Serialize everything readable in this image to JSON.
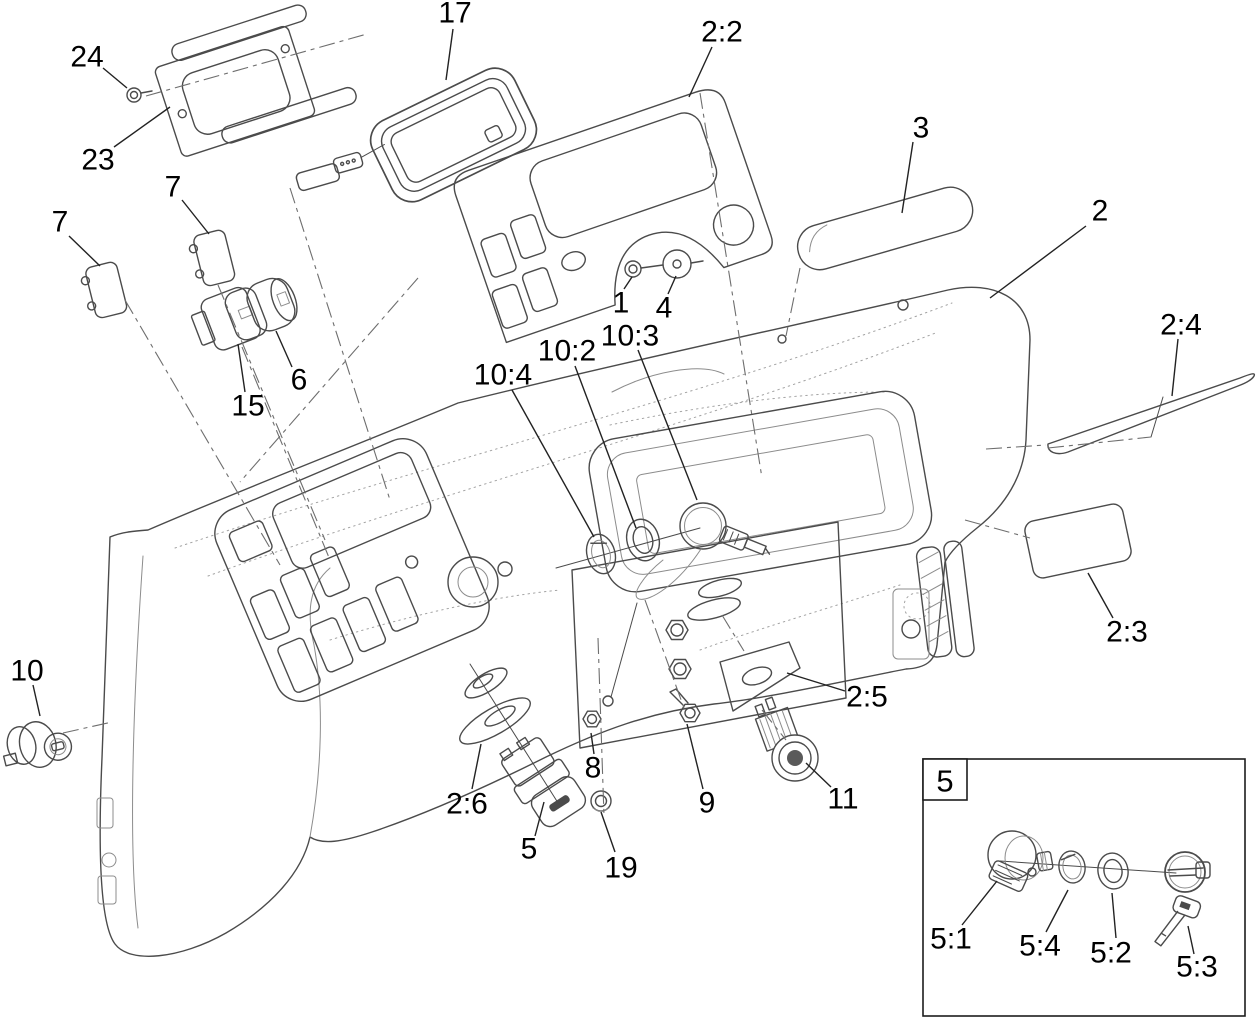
{
  "figure": {
    "type": "exploded-parts-diagram",
    "subject": "console-dashboard-assembly",
    "background_color": "#ffffff",
    "line_color": "#4b4b4b",
    "label_color": "#000000"
  },
  "inset": {
    "label": "5"
  },
  "callouts": [
    {
      "id": "24",
      "label": "24",
      "x": 87,
      "y": 57,
      "leader": [
        103,
        68,
        127,
        88
      ]
    },
    {
      "id": "23",
      "label": "23",
      "x": 98,
      "y": 160,
      "leader": [
        114,
        147,
        170,
        107
      ]
    },
    {
      "id": "17",
      "label": "17",
      "x": 455,
      "y": 13,
      "leader": [
        453,
        29,
        446,
        80
      ]
    },
    {
      "id": "2-2",
      "label": "2:2",
      "x": 722,
      "y": 32,
      "leader": [
        712,
        47,
        689,
        97
      ]
    },
    {
      "id": "3",
      "label": "3",
      "x": 921,
      "y": 128,
      "leader": [
        913,
        142,
        902,
        213
      ]
    },
    {
      "id": "2",
      "label": "2",
      "x": 1100,
      "y": 211,
      "leader": [
        1086,
        226,
        990,
        298
      ]
    },
    {
      "id": "7-upper",
      "label": "7",
      "x": 173,
      "y": 187,
      "leader": [
        182,
        200,
        209,
        234
      ]
    },
    {
      "id": "7-left",
      "label": "7",
      "x": 60,
      "y": 222,
      "leader": [
        69,
        236,
        100,
        266
      ]
    },
    {
      "id": "6",
      "label": "6",
      "x": 299,
      "y": 380,
      "leader": [
        292,
        367,
        276,
        331
      ]
    },
    {
      "id": "15",
      "label": "15",
      "x": 248,
      "y": 406,
      "leader": [
        245,
        392,
        238,
        344
      ]
    },
    {
      "id": "1",
      "label": "1",
      "x": 621,
      "y": 303,
      "leader": [
        624,
        289,
        632,
        277
      ]
    },
    {
      "id": "4",
      "label": "4",
      "x": 664,
      "y": 308,
      "leader": [
        668,
        294,
        676,
        276
      ]
    },
    {
      "id": "10-3",
      "label": "10:3",
      "x": 630,
      "y": 336,
      "leader": [
        638,
        350,
        697,
        500
      ]
    },
    {
      "id": "10-2",
      "label": "10:2",
      "x": 567,
      "y": 351,
      "leader": [
        575,
        366,
        636,
        528
      ]
    },
    {
      "id": "10-4",
      "label": "10:4",
      "x": 503,
      "y": 375,
      "leader": [
        512,
        390,
        594,
        537
      ]
    },
    {
      "id": "2-4",
      "label": "2:4",
      "x": 1181,
      "y": 325,
      "leader": [
        1178,
        339,
        1172,
        396
      ]
    },
    {
      "id": "10",
      "label": "10",
      "x": 27,
      "y": 671,
      "leader": [
        33,
        685,
        40,
        716
      ]
    },
    {
      "id": "2-3",
      "label": "2:3",
      "x": 1127,
      "y": 632,
      "leader": [
        1113,
        618,
        1088,
        573
      ]
    },
    {
      "id": "2-5",
      "label": "2:5",
      "x": 867,
      "y": 697,
      "leader": [
        845,
        691,
        787,
        673
      ]
    },
    {
      "id": "2-6",
      "label": "2:6",
      "x": 467,
      "y": 804,
      "leader": [
        472,
        789,
        481,
        744
      ]
    },
    {
      "id": "5",
      "label": "5",
      "x": 529,
      "y": 849,
      "leader": [
        535,
        836,
        544,
        802
      ]
    },
    {
      "id": "8",
      "label": "8",
      "x": 593,
      "y": 768,
      "leader": [
        594,
        754,
        591,
        733
      ]
    },
    {
      "id": "19",
      "label": "19",
      "x": 621,
      "y": 868,
      "leader": [
        615,
        852,
        601,
        812
      ]
    },
    {
      "id": "9",
      "label": "9",
      "x": 707,
      "y": 803,
      "leader": [
        703,
        789,
        687,
        724
      ]
    },
    {
      "id": "11",
      "label": "11",
      "x": 843,
      "y": 799,
      "leader": [
        831,
        787,
        806,
        763
      ]
    },
    {
      "id": "5-1",
      "label": "5:1",
      "x": 951,
      "y": 939,
      "leader": [
        962,
        925,
        997,
        881
      ]
    },
    {
      "id": "5-4",
      "label": "5:4",
      "x": 1040,
      "y": 946,
      "leader": [
        1046,
        932,
        1068,
        890
      ]
    },
    {
      "id": "5-2",
      "label": "5:2",
      "x": 1111,
      "y": 953,
      "leader": [
        1116,
        938,
        1112,
        893
      ]
    },
    {
      "id": "5-3",
      "label": "5:3",
      "x": 1197,
      "y": 967,
      "leader": [
        1194,
        954,
        1188,
        926
      ]
    }
  ]
}
